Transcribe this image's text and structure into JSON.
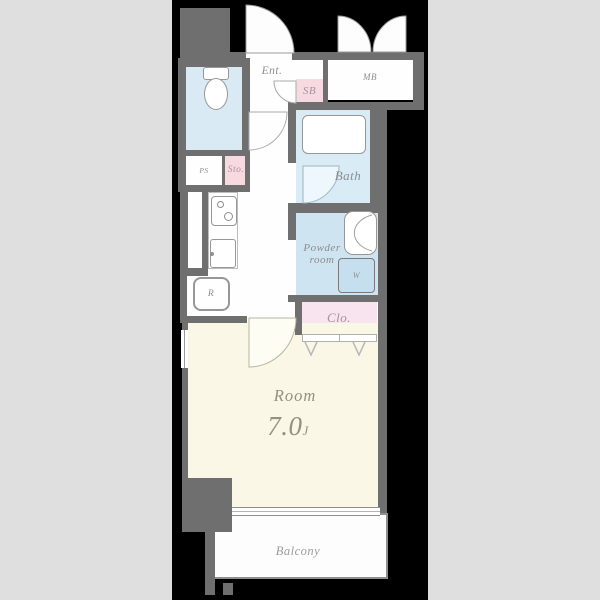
{
  "floorplan": {
    "palette": {
      "canvas_bg": "#dfdfdf",
      "plan_bg": "#000000",
      "wall": "#6f6f6f",
      "water_blue": "#d9eaf5",
      "powder_blue": "#cfe4f1",
      "pink": "#f7d9e2",
      "clo_pink": "#f8e4ee",
      "room_cream": "#faf7e6",
      "label_gray": "#8d8d8d"
    },
    "rooms": {
      "entrance": {
        "label": "Ent."
      },
      "shoe_box": {
        "label": "SB"
      },
      "meter_box": {
        "label": "MB"
      },
      "pipe_space": {
        "label": "PS"
      },
      "storage": {
        "label": "Sto."
      },
      "refrigerator": {
        "label": "R"
      },
      "bath": {
        "label": "Bath"
      },
      "powder_room": {
        "label_line1": "Powder",
        "label_line2": "room"
      },
      "washer": {
        "label": "W"
      },
      "closet": {
        "label": "Clo."
      },
      "main_room": {
        "label": "Room",
        "size_value": "7.0",
        "size_unit": "J"
      },
      "balcony": {
        "label": "Balcony"
      }
    }
  }
}
